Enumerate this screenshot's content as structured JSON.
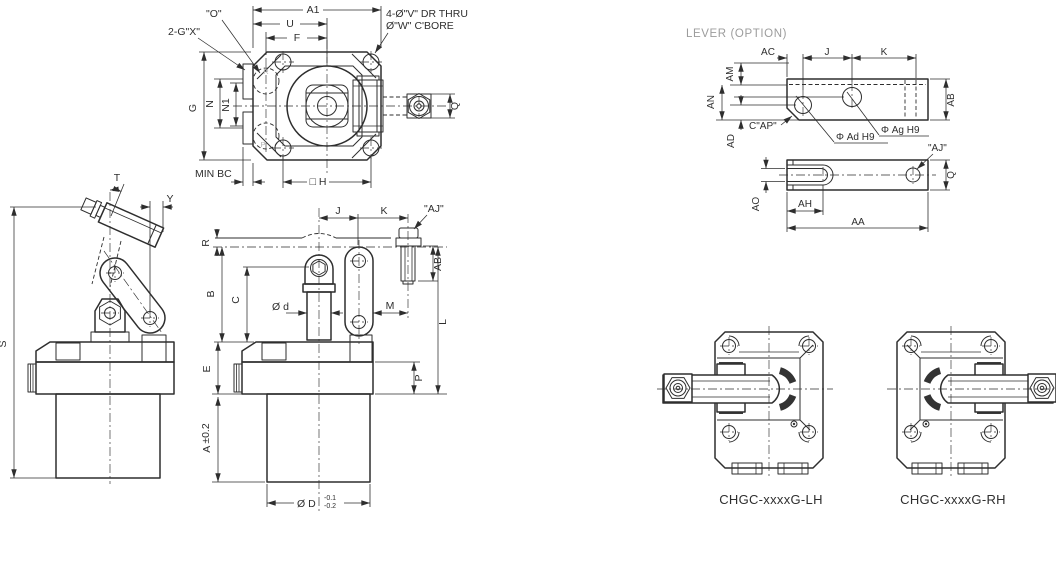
{
  "lever_section_title": "LEVER (OPTION)",
  "top_view": {
    "a1": "A1",
    "u": "U",
    "f": "F",
    "o": "\"O\"",
    "gx": "2-G\"X\"",
    "drill_note_1": "4-Ø\"V\" DR THRU",
    "drill_note_2": "Ø\"W\" C'BORE",
    "g": "G",
    "n": "N",
    "n1": "N1",
    "min_bc": "MIN BC",
    "square_h": "□ H",
    "q": "Q",
    "port_r": "R",
    "port_p": "P"
  },
  "side_view": {
    "t": "T",
    "y": "Y",
    "s": "S"
  },
  "front_view": {
    "r": "R",
    "j": "J",
    "k": "K",
    "aj": "\"AJ\"",
    "ab": "AB",
    "b": "B",
    "c": "C",
    "dia_d": "Ø d",
    "m": "M",
    "l": "L",
    "e": "E",
    "p": "P",
    "a": "A",
    "a_tol": "±0.2",
    "dia_D": "Ø D",
    "d_tol_upper": "-0.1",
    "d_tol_lower": "-0.2"
  },
  "lever_top_view": {
    "ac": "AC",
    "j": "J",
    "k": "K",
    "am": "AM",
    "an": "AN",
    "ad": "AD",
    "ab": "AB",
    "cap": "C\"AP\"",
    "dia_ad": "Φ Ad H9",
    "dia_ag": "Φ Ag H9"
  },
  "lever_bottom_view": {
    "aj": "\"AJ\"",
    "q": "Q",
    "ao": "AO",
    "ah": "AH",
    "aa": "AA"
  },
  "models": {
    "lh": "CHGC-xxxxG-LH",
    "rh": "CHGC-xxxxG-RH"
  }
}
